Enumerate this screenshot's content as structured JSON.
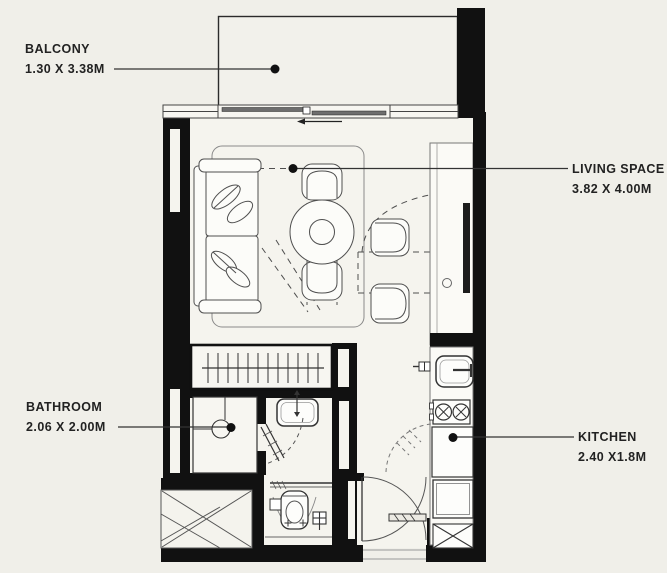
{
  "plan": {
    "colors": {
      "background": "#f0efe9",
      "wall": "#111111",
      "furniture_line": "#4f4f4f",
      "floor_fill": "#f5f4ee",
      "leader_line": "#333333"
    },
    "rooms": {
      "balcony": {
        "name": "BALCONY",
        "dims": "1.30 X 3.38M"
      },
      "living": {
        "name": "LIVING SPACE",
        "dims": "3.82 X 4.00M"
      },
      "bathroom": {
        "name": "BATHROOM",
        "dims": "2.06 X 2.00M"
      },
      "kitchen": {
        "name": "KITCHEN",
        "dims": "2.40 X1.8M"
      }
    }
  }
}
